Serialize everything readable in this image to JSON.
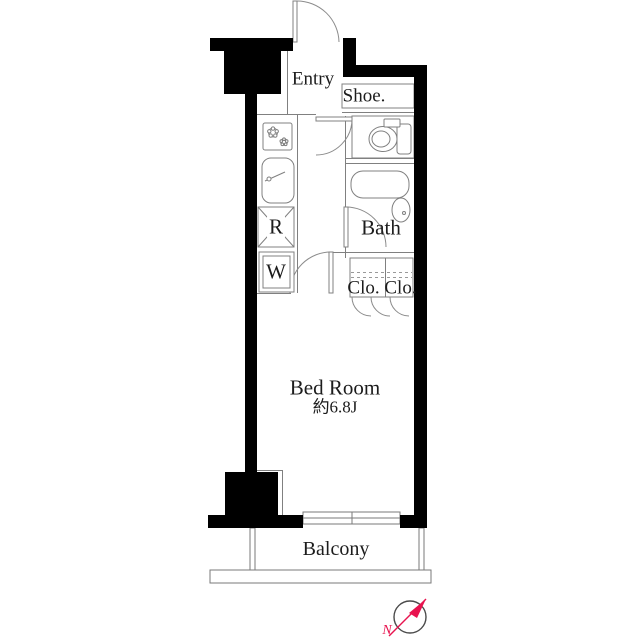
{
  "document": {
    "kind": "apartment-floor-plan"
  },
  "labels": {
    "entry": "Entry",
    "shoe": "Shoe.",
    "refrigerator": "R",
    "washer": "W",
    "bath": "Bath",
    "closet": "Clo. Clo.",
    "bedroom_name": "Bed Room",
    "bedroom_area": "約6.8J",
    "balcony": "Balcony",
    "compass_north": "N"
  },
  "icons": {
    "stove": "stove-burners-icon",
    "sink": "kitchen-sink-icon",
    "toilet": "toilet-icon",
    "bathtub": "bathtub-icon",
    "washbasin": "washbasin-icon",
    "compass": "north-compass-icon"
  },
  "colors": {
    "wall": "#000000",
    "thin_line": "#808080",
    "text": "#1c1c1c",
    "compass_needle": "#e8134f",
    "background": "#ffffff"
  }
}
